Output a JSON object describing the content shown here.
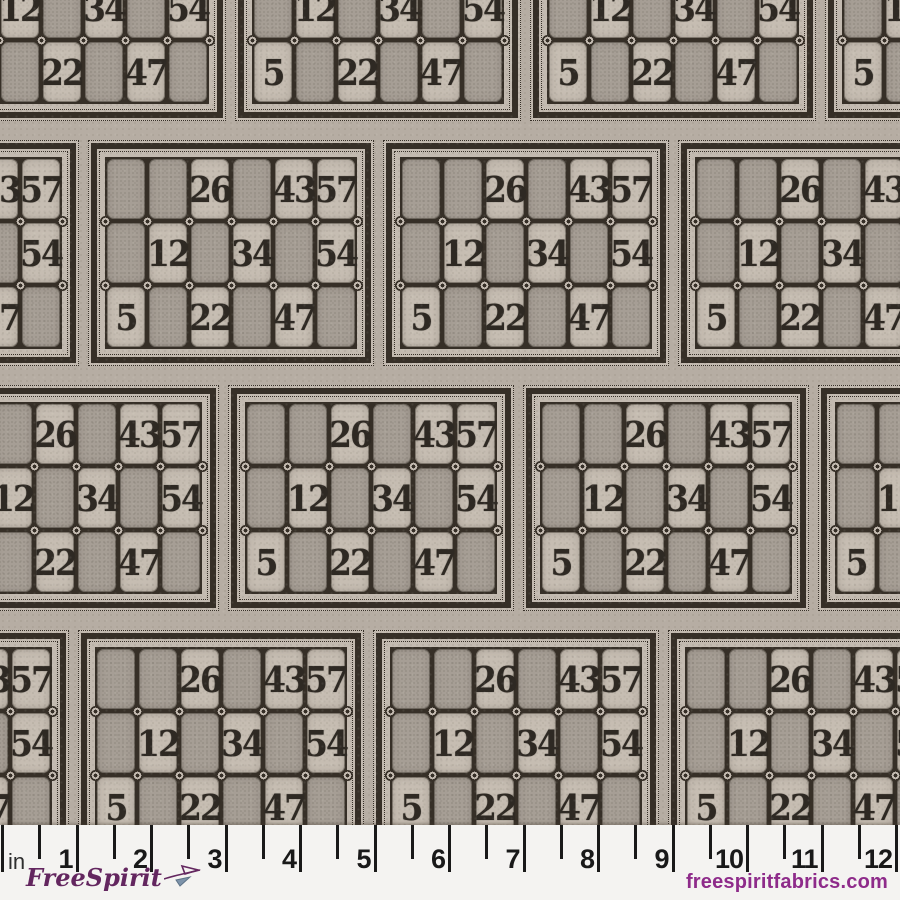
{
  "pattern": {
    "card_rows": [
      [
        "",
        "",
        "26",
        "",
        "43",
        "57"
      ],
      [
        "",
        "12",
        "",
        "34",
        "",
        "54"
      ],
      [
        "5",
        "",
        "22",
        "",
        "47",
        ""
      ]
    ]
  },
  "ruler": {
    "unit_label": "in",
    "inch_labels": [
      "1",
      "2",
      "3",
      "4",
      "5",
      "6",
      "7",
      "8",
      "9",
      "10",
      "11",
      "12"
    ]
  },
  "branding": {
    "logo_text": "FreeSpirit",
    "logo_icon": "kite-flourish-icon",
    "website": "freespiritfabrics.com"
  },
  "colors": {
    "fabric_background": "#b6ada3",
    "card_background": "#c3bab0",
    "light_cell": "#c6bdb2",
    "dark_cell": "#a69e95",
    "frame_ink": "#362f27",
    "number_ink": "#2e2923",
    "ruler_background": "#f4f3f1",
    "tick_ink": "#191919",
    "logo_purple": "#63265f",
    "website_purple": "#8e2b8a",
    "icon_blue": "#7d93aa"
  }
}
